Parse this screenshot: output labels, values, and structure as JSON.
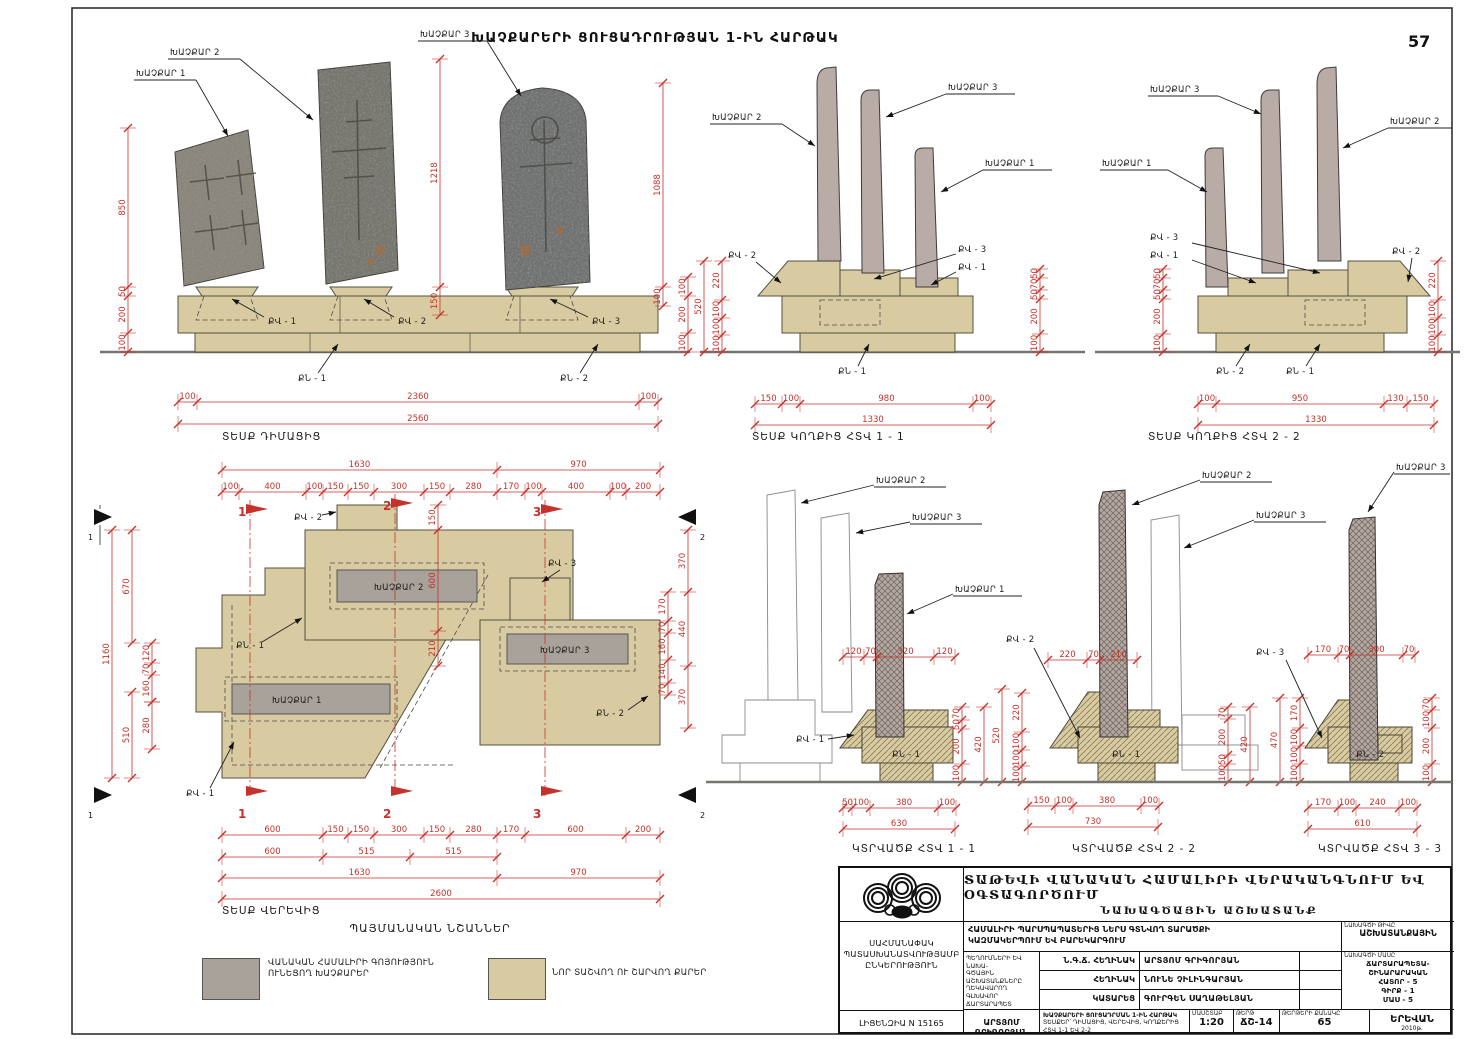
{
  "page": {
    "number": "57",
    "title": "ԽԱՉՔԱՐԵՐԻ ՑՈՒՑԱԴՐՈՒԹՅԱՆ 1-ԻՆ ՀԱՐԹԱԿ"
  },
  "colors": {
    "dimension_red": "#c5322b",
    "new_stone_tan": "#d8cba2",
    "existing_stone_gray": "#a9a29a"
  },
  "labels": {
    "kh1": "ԽԱՉՔԱՐ 1",
    "kh2": "ԽԱՉՔԱՐ 2",
    "kh3": "ԽԱՉՔԱՐ 3",
    "qv1": "ՔՎ - 1",
    "qv2": "ՔՎ - 2",
    "qv3": "ՔՎ - 3",
    "qn1": "ՔՆ - 1",
    "qn2": "ՔՆ - 2"
  },
  "views": {
    "front": {
      "caption": "ՏԵՍՔ ԴԻՄԱՑԻՑ",
      "dims": {
        "left": [
          850,
          50,
          200,
          100
        ],
        "mid": [
          1218,
          150
        ],
        "kh3": [
          1088,
          100
        ],
        "right": [
          100,
          200,
          100
        ],
        "bottom": [
          100,
          2360,
          100
        ],
        "total": [
          2560
        ]
      }
    },
    "side1": {
      "caption": "ՏԵՍՔ ԿՈՂՔԻՑ ՀՏՎ 1 - 1",
      "dims": {
        "left_total": [
          520
        ],
        "left": [
          220,
          100,
          100,
          100
        ],
        "right": [
          50,
          70,
          50,
          200,
          100
        ],
        "bottom": [
          150,
          100,
          980,
          100
        ],
        "total": [
          1330
        ]
      }
    },
    "side2": {
      "caption": "ՏԵՍՔ ԿՈՂՔԻՑ ՀՏՎ 2 - 2",
      "dims": {
        "left": [
          50,
          70,
          50,
          200,
          100
        ],
        "right": [
          220,
          100,
          100,
          100
        ],
        "bottom": [
          100,
          950,
          130,
          150
        ],
        "total": [
          1330
        ]
      }
    },
    "plan": {
      "caption": "ՏԵՍՔ ՎԵՐԵՎԻՑ",
      "section_markers": [
        "1",
        "2",
        "3"
      ],
      "view_markers": [
        "1",
        "2"
      ],
      "dims": {
        "top_major": [
          1630,
          970
        ],
        "top": [
          100,
          400,
          100,
          150,
          150,
          300,
          150,
          280,
          170,
          100,
          400,
          100,
          200
        ],
        "bottom": [
          600,
          150,
          150,
          300,
          150,
          280,
          170,
          600,
          200
        ],
        "bottom_sections": [
          600,
          515,
          515
        ],
        "bottom_major": [
          1630,
          970
        ],
        "bottom_total": [
          2600
        ],
        "left_outer": [
          1160
        ],
        "left_upper": [
          670
        ],
        "left_lower": [
          510
        ],
        "left_small": [
          120,
          70,
          160
        ],
        "left_small2": [
          280
        ],
        "right_outer": [
          370,
          440,
          370
        ],
        "right_inner": [
          170,
          70,
          160,
          140,
          70
        ],
        "middle": [
          150,
          600,
          210
        ]
      }
    },
    "sec1": {
      "caption": "ԿՏՐՎԱԾՔ ՀՏՎ 1 - 1",
      "dims": {
        "top": [
          120,
          70,
          320,
          120
        ],
        "right": [
          70,
          50,
          200,
          100
        ],
        "right_outer": [
          420
        ],
        "bottom": [
          50,
          100,
          380,
          100
        ],
        "total": [
          630
        ]
      }
    },
    "sec2": {
      "caption": "ԿՏՐՎԱԾՔ ՀՏՎ 2 - 2",
      "dims": {
        "top": [
          220,
          70,
          210
        ],
        "left": [
          220,
          100,
          100,
          100
        ],
        "left_outer": [
          520
        ],
        "right": [
          70,
          200,
          50,
          100
        ],
        "right_outer": [
          420
        ],
        "bottom": [
          150,
          100,
          380,
          100
        ],
        "total": [
          730
        ]
      }
    },
    "sec3": {
      "caption": "ԿՏՐՎԱԾՔ ՀՏՎ 3 - 3",
      "dims": {
        "top": [
          170,
          70,
          300,
          70
        ],
        "left": [
          170,
          100,
          100,
          100
        ],
        "left_outer": [
          470
        ],
        "right": [
          70,
          100,
          200,
          100
        ],
        "bottom": [
          170,
          100,
          240,
          100
        ],
        "total": [
          610
        ]
      }
    }
  },
  "legend": {
    "title": "ՊԱՅՄԱՆԱԿԱՆ ՆՇԱՆՆԵՐ",
    "existing_line1": "ՎԱՆԱԿԱՆ ՀԱՄԱԼԻՐԻ ԳՈՅՈՒԹՅՈՒՆ",
    "existing_line2": "ՈՒՆԵՑՈՂ ԽԱՉՔԱՐԵՐ",
    "new_text": "ՆՈՐ ՏԱՇՎՈՂ ՈՒ ՇԱՐՎՈՂ ՔԱՐԵՐ"
  },
  "titleblock": {
    "company_line1": "ՍԱՀՄԱՆԱՓԱԿ",
    "company_line2": "ՊԱՏԱՍԽԱՆԱՏՎՈՒԹՅԱՄԲ",
    "company_line3": "ԸՆԿԵՐՈՒԹՅՈՒՆ",
    "license": "ԼԻՑԵՆԶԻԱ N 15165",
    "project_title_line1": "ՏԱԹԵՎԻ ՎԱՆԱԿԱՆ ՀԱՄԱԼԻՐԻ ՎԵՐԱԿԱՆԳՆՈՒՄ ԵՎ ՕԳՏԱԳՈՐԾՈՒՄ",
    "project_title_line2": "ՆԱԽԱԳԾԱՅԻՆ ԱՇԽԱՏԱՆՔ",
    "section_title_line1": "ՀԱՄԱԼԻՐԻ ՊԱՐՍՊԱՊԱՏԵՐԻՑ ՆԵՐՍ ԳՏՆՎՈՂ ՏԱՐԱԾՔԻ",
    "section_title_line2": "ԿԱԶՄԱԿԵՐՊՈՒՄ ԵՎ ԲԱՐԵԿԱՐԳՈՒՄ",
    "chief_line1": "ՊԵՂՈՒՄՆԵՐԻ ԵՎ ՆԱԽԱ-",
    "chief_line2": "ԳԾԱՅԻՆ ԱՇԽԱՏԱՆՔՆԵՐԸ",
    "chief_line3": "ՂԵԿԱՎԱՐՈՂ ԳԼԽԱՎՈՐ",
    "chief_line4": "ՃԱՐՏԱՐԱՊԵՏ",
    "roles": [
      {
        "role": "Ն.Գ.Ճ. ՀԵՂԻՆԱԿ",
        "name": "ԱՐՏՅՈՄ ԳՐԻԳՈՐՅԱՆ"
      },
      {
        "role": "ՀԵՂԻՆԱԿ",
        "name": "ՆՈՒՆԵ ՉԻԼԻՆԳԱՐՅԱՆ"
      },
      {
        "role": "ԿԱՏԱՐԵՑ",
        "name": "ԳՈՒՐԳԵՆ ՍԱՂԱԹԵԼՅԱՆ"
      }
    ],
    "author2": "ԱՐՏՅՈՄ ԳՐԻԳՈՐՅԱՆ",
    "drawing_desc_line1": "ԽԱՉՔԱՐԵՐԻ ՑՈՒՑԱԴՐՄԱՆ 1-ԻՆ ՀԱՐԹԱԿ",
    "drawing_desc_line2": "ՏԵՍՔԵՐ՝ ԴԻՄԱՑԻՑ, ՎԵՐԵՎԻՑ, ԿՈՂՔԵՐԻՑ ՀՏՎ 1-1 ԵՎ 2-2",
    "drawing_desc_line3": "ԿՏՐՎԱԾՔՆԵՐ ՀՏՎ 1-1, 2-2 ԵՎ 3-3",
    "scale_label": "ՄԱՍՇՏԱԲ",
    "scale_value": "1:20",
    "sheet_label": "ԹԵՐԹ",
    "sheet_value": "ՃՇ-14",
    "proj_no_label": "ՆԱԽԱԳԾԻ ԹԻՎԸ",
    "proj_no_value": "ԱՇԽԱՏԱՆՔԱՅԻՆ",
    "part_label": "ՆԱԽԱԳԾԻ ՄԱՍԸ",
    "part_line1": "ՃԱՐՏԱՐԱՊԵՏԱ-",
    "part_line2": "ՇԻՆԱՐԱՐԱԿԱՆ",
    "part_line3": "ՀԱՏՈՐ - 5",
    "part_line4": "ԳԻՐՔ - 1",
    "part_line5": "ՄԱՍ - 5",
    "sheets_label": "ԹԵՐԹԵՐԻ ՔԱՆԱԿԸ",
    "sheets_value": "65",
    "city": "ԵՐԵՎԱՆ",
    "year": "2010թ."
  }
}
